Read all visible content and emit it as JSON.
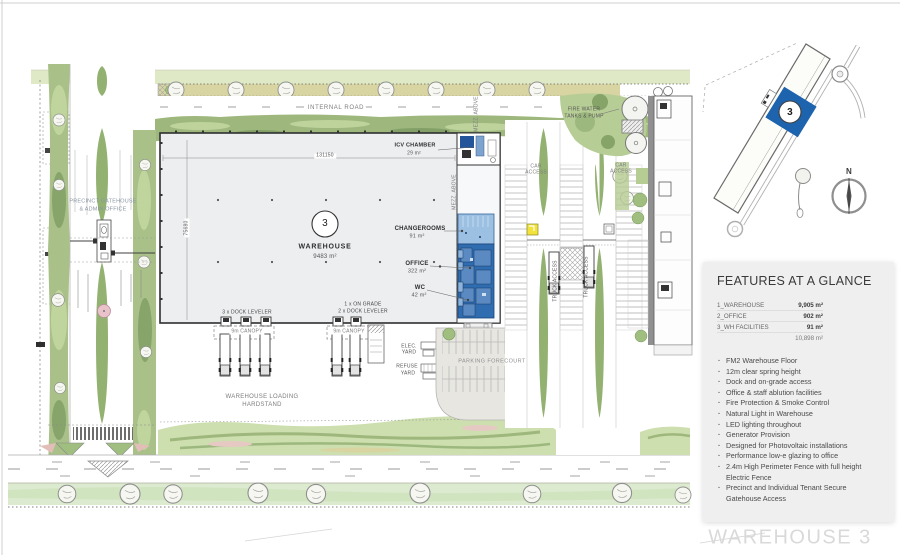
{
  "page": {
    "drawing_title": "WAREHOUSE 3"
  },
  "locator": {
    "building_number": "3",
    "north": "N"
  },
  "features": {
    "heading": "FEATURES AT A GLANCE",
    "areas": [
      {
        "label": "1_WAREHOUSE",
        "value": "9,905 m²"
      },
      {
        "label": "2_OFFICE",
        "value": "902 m²"
      },
      {
        "label": "3_WH FACILITIES",
        "value": "91 m²"
      }
    ],
    "total": "10,898 m²",
    "bullets": [
      "FM2 Warehouse Floor",
      "12m clear spring height",
      "Dock and on-grade access",
      "Office & staff ablution facilities",
      "Fire Protection & Smoke Control",
      "Natural Light in Warehouse",
      "LED lighting throughout",
      "Generator Provision",
      "Designed for Photovoltaic installations",
      "Performance low-e glazing to office",
      "2.4m High Perimeter Fence with full height Electric Fence",
      "Precinct and Individual Tenant Secure Gatehouse Access"
    ]
  },
  "plan": {
    "internal_road": "INTERNAL ROAD",
    "fire_water_1": "FIRE WATER",
    "fire_water_2": "TANKS & PUMP",
    "icv_name": "ICV CHAMBER",
    "icv_area": "29 m²",
    "car_access_line1": "CAR",
    "car_access_line2": "ACCESS",
    "truck_access": "TRUCK ACCESS",
    "mezz_above": "MEZZ. ABOVE",
    "warehouse_number": "3",
    "warehouse_name": "WAREHOUSE",
    "warehouse_area": "9483 m²",
    "changerooms_name": "CHANGEROOMS",
    "changerooms_area": "91 m²",
    "office_name": "OFFICE",
    "office_area": "322 m²",
    "wc_name": "WC",
    "wc_area": "42 m²",
    "dim_width": "131150",
    "dim_depth": "75680",
    "dock_group1_levelers": "3 x DOCK LEVELER",
    "dock_group2_ongrade": "1 x ON GRADE",
    "dock_group2_levelers": "2 x DOCK LEVELER",
    "canopy": "9m CANOPY",
    "elec_yard_1": "ELEC.",
    "elec_yard_2": "YARD",
    "refuse_yard_1": "REFUSE",
    "refuse_yard_2": "YARD",
    "parking_forecourt": "PARKING FORECOURT",
    "loading_1": "WAREHOUSE LOADING",
    "loading_2": "HARDSTAND",
    "gatehouse_1": "PRECINCT GATEHOUSE",
    "gatehouse_2": "& ADMIN OFFICE"
  },
  "colors": {
    "office_blue": "#2f6cb0",
    "changerooms_blue": "#9cc0e2",
    "locator_blue": "#1e63ae",
    "landscape_green": "#9db77d",
    "verge_khaki": "#d8d5a2",
    "hut_yellow": "#f2e23a",
    "panel_bg": "#efefef"
  }
}
